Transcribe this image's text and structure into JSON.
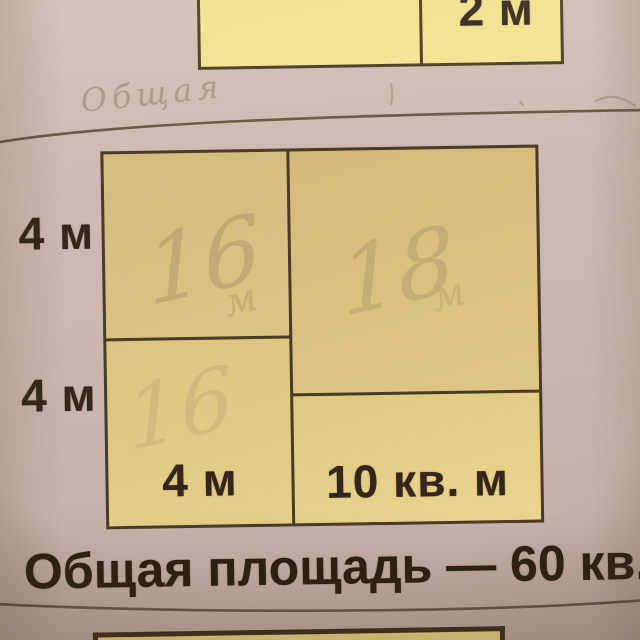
{
  "photo": {
    "top_figure": {
      "right_cell_label": "2 м"
    },
    "pencil": {
      "top_note": "Общая",
      "top_left_cell": "16",
      "top_left_cell_unit": "м",
      "top_right_cell": "18",
      "top_right_cell_unit": "м",
      "bottom_left_cell": "16"
    },
    "diagram": {
      "side_labels": [
        "4 м",
        "4 м"
      ],
      "bottom_left_label": "4 м",
      "bottom_right_label": "10 кв. м"
    },
    "caption": "Общая площадь — 60 кв."
  },
  "colors": {
    "paper": "#ccb9b1",
    "card_line": "#5c4b3a",
    "figure_fill": "#e0c883",
    "figure_fill_bright": "#f2e18d",
    "figure_border": "#4a3a26",
    "ink": "#2b2013",
    "pencil": "#8a795c"
  }
}
